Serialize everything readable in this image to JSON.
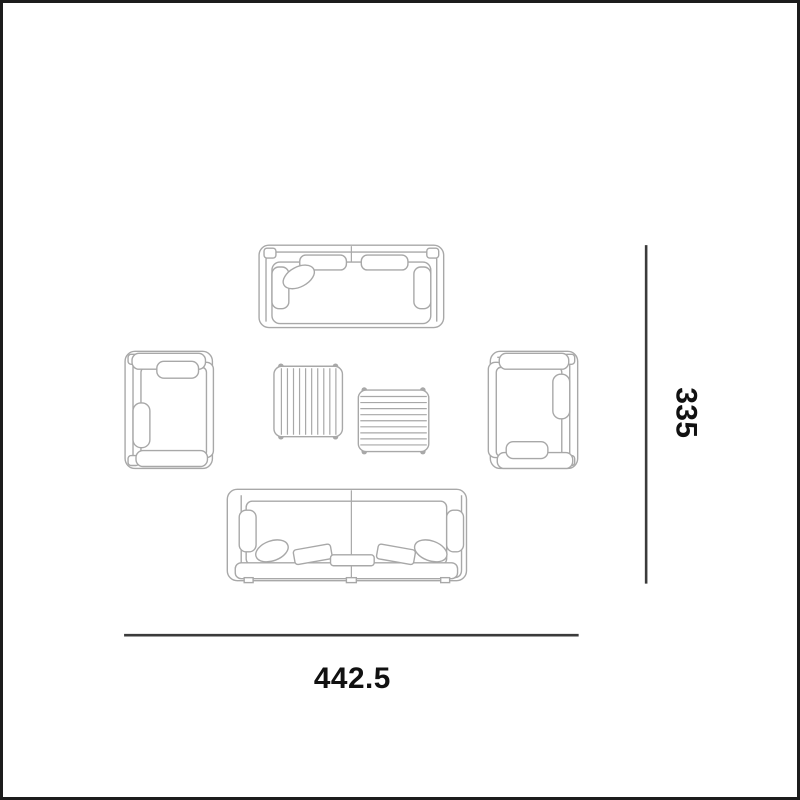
{
  "theme": {
    "background": "#ffffff",
    "border_color": "#1c1c1c",
    "furniture_stroke": "#a8a8a8",
    "dimension_line": "#3b3b3b",
    "label_text": "#111111"
  },
  "diagram": {
    "kind": "lounge-furniture-set-top-view-dimension-drawing",
    "dimension_width": {
      "label": "442.5"
    },
    "dimension_height": {
      "label": "335"
    },
    "furniture": [
      {
        "name": "two-seat-sofa",
        "position": "top"
      },
      {
        "name": "armchair",
        "position": "left"
      },
      {
        "name": "armchair",
        "position": "right"
      },
      {
        "name": "slatted-coffee-table-large",
        "position": "center-left"
      },
      {
        "name": "slatted-coffee-table-small",
        "position": "center-right"
      },
      {
        "name": "three-seat-sofa",
        "position": "bottom"
      }
    ]
  }
}
